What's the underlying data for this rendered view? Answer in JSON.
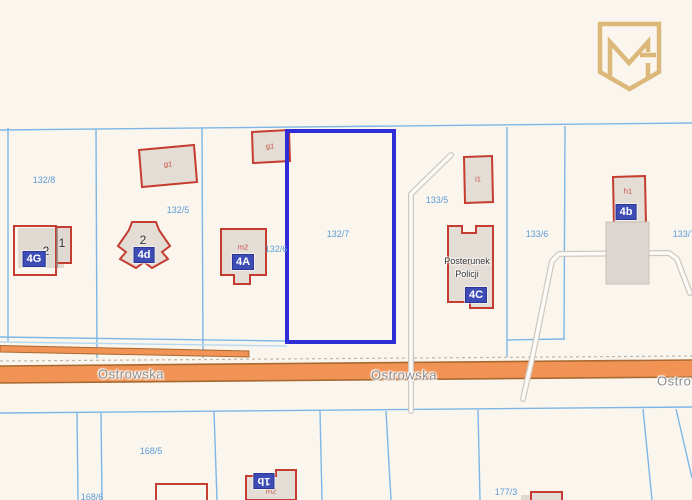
{
  "road": {
    "labels": [
      "Ostrowska",
      "Ostrowska",
      "Ostrowska"
    ]
  },
  "parcels": {
    "highlighted": "132/7",
    "labels": [
      "132/8",
      "132/5",
      "132/6",
      "132/7",
      "133/5",
      "133/6",
      "133/7",
      "168/5",
      "168/6",
      "177/3"
    ]
  },
  "buildings": {
    "labels": [
      "g1",
      "g1",
      "m2",
      "i1",
      "h1",
      "b1",
      "m2"
    ],
    "chips": [
      "4G",
      "4d",
      "4A",
      "4C",
      "4b",
      "1b"
    ],
    "numbers": [
      "2",
      "1",
      "2"
    ],
    "police_line1": "Posterunek",
    "police_line2": "Policji"
  },
  "colors": {
    "background": "#faf6ee",
    "parcel_line": "#7db6e6",
    "highlight_blue": "#2f2dd5",
    "parcel_label_blue": "#5f9bd6",
    "building_fill": "#e4ddd6",
    "building_stroke": "#c43d30",
    "chip_indigo": "#3e4cb6",
    "road_fill": "#f19355",
    "road_border": "#a96a31",
    "road_label_gray": "#8d8c8a",
    "logo_gold": "#dcb97b"
  }
}
